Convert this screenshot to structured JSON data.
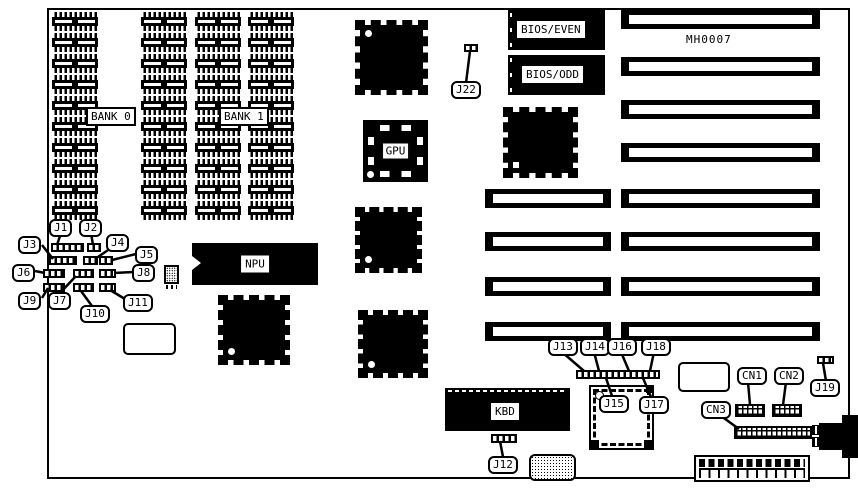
{
  "board": {
    "model_text": "MH0007"
  },
  "memory": {
    "bank0_label": "BANK 0",
    "bank1_label": "BANK 1"
  },
  "chips": {
    "npu_label": "NPU",
    "gpu_label": "GPU",
    "kbd_label": "KBD",
    "bios_even_label": "BIOS/EVEN",
    "bios_odd_label": "BIOS/ODD"
  },
  "jumpers": [
    {
      "label": "J1"
    },
    {
      "label": "J2"
    },
    {
      "label": "J3"
    },
    {
      "label": "J4"
    },
    {
      "label": "J5"
    },
    {
      "label": "J6"
    },
    {
      "label": "J7"
    },
    {
      "label": "J8"
    },
    {
      "label": "J9"
    },
    {
      "label": "J10"
    },
    {
      "label": "J11"
    },
    {
      "label": "J12"
    },
    {
      "label": "J13"
    },
    {
      "label": "J14"
    },
    {
      "label": "J15"
    },
    {
      "label": "J16"
    },
    {
      "label": "J17"
    },
    {
      "label": "J18"
    },
    {
      "label": "J19"
    },
    {
      "label": "J22"
    }
  ],
  "connectors": [
    {
      "label": "CN1"
    },
    {
      "label": "CN2"
    },
    {
      "label": "CN3"
    }
  ]
}
